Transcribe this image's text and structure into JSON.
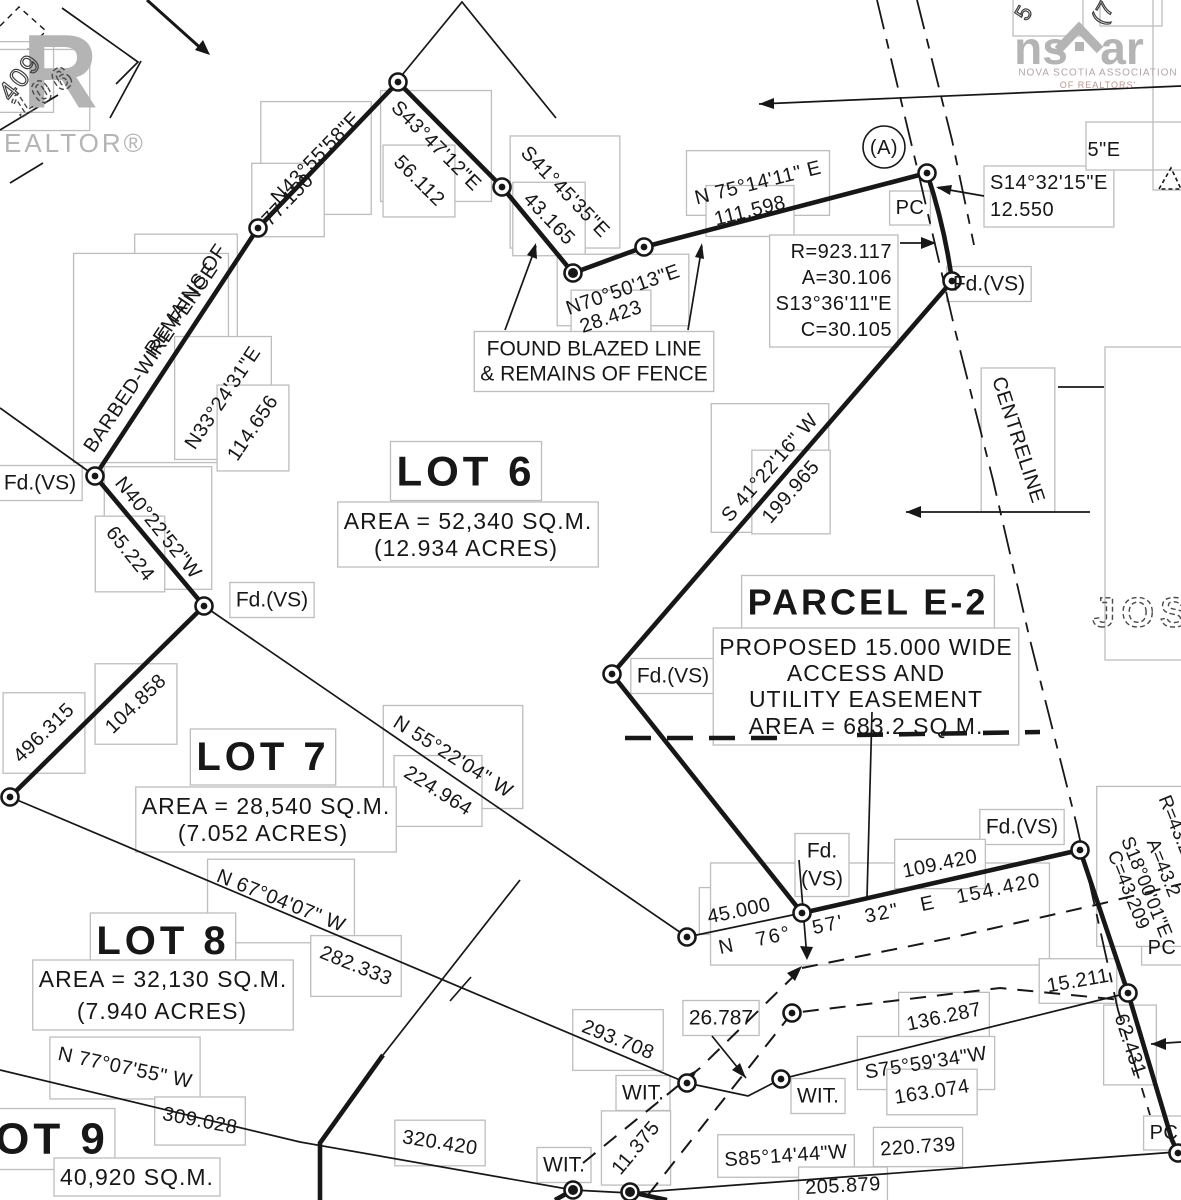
{
  "colors": {
    "ink": "#171717",
    "label_box_border": "#bdbdbd",
    "logo_gray": "#b4b4b4",
    "nsar_red_gray": "#bf9494"
  },
  "logos": {
    "realtor_r": "R",
    "realtor_text": "REALTOR®",
    "nsar_ns": "ns",
    "nsar_ar": "ar",
    "nsar_line1": "NOVA SCOTIA ASSOCIATION",
    "nsar_line2": "OF REALTORS'"
  },
  "labels": {
    "n43_bearing": "N43°55'58\"E",
    "n43_dist": "77.150",
    "s43_bearing": "S43°47'12\"E",
    "s43_dist": "56.112",
    "s41_bearing": "S41°45'35\"E",
    "s41_dist": "43.165",
    "n70_bearing": "N70°50'13\"E",
    "n70_dist": "28.423",
    "n75_bearing": "N 75°14'11\" E",
    "n75_dist": "111.598",
    "s14_bearing": "S14°32'15\"E",
    "s14_dist": "12.550",
    "pc_top": "PC",
    "point_a": "(A)",
    "curve1_r": "R=923.117",
    "curve1_a": "A=30.106",
    "curve1_bearing": "S13°36'11\"E",
    "curve1_c": "C=30.105",
    "fd_vs_1": "Fd.(VS)",
    "fd_vs_2": "Fd.(VS)",
    "fd_vs_3": "Fd.(VS)",
    "fd_vs_6": "Fd.(VS)",
    "fd_vs_5": "Fd.(VS)",
    "fd_vs_4a": "Fd.",
    "fd_vs_4b": "(VS)",
    "found_line1": "FOUND BLAZED LINE",
    "found_line2": "& REMAINS OF FENCE",
    "lot6_title": "LOT 6",
    "lot6_area": "AREA = 52,340 SQ.M.",
    "lot6_acres": "(12.934 ACRES)",
    "s4122_bearing": "S 41°22'16\" W",
    "s4122_dist": "199.965",
    "centreline": "CENTRELINE",
    "parcel_title": "PARCEL E-2",
    "parcel_l1": "PROPOSED 15.000 WIDE",
    "parcel_l2": "ACCESS AND",
    "parcel_l3": "UTILITY EASEMENT",
    "parcel_l4": "AREA = 683.2 SQ.M.",
    "remains1": "REMAINS OF",
    "remains2": "BARBED-WIRE FENCE",
    "n33_bearing": "N33°24'31\"E",
    "n33_dist": "114.656",
    "n40_bearing": "N40°22'52\"W",
    "n40_dist": "65.224",
    "d496": "496.315",
    "d104": "104.858",
    "lot7_title": "LOT 7",
    "lot7_area": "AREA = 28,540 SQ.M.",
    "lot7_acres": "(7.052 ACRES)",
    "n55_bearing": "N 55°22'04\" W",
    "n55_dist": "224.964",
    "n67_bearing": "N 67°04'07\" W",
    "n67_dist": "282.333",
    "lot8_title": "LOT 8",
    "lot8_area": "AREA = 32,130 SQ.M.",
    "lot8_acres": "(7.940 ACRES)",
    "n77_bearing": "N 77°07'55\" W",
    "n77_dist": "309.028",
    "lot9_title": "OT 9",
    "lot9_area": "40,920 SQ.M.",
    "d320": "320.420",
    "d293": "293.708",
    "wit1": "WIT.",
    "wit2": "WIT.",
    "wit3": "WIT.",
    "d11": "11.375",
    "d26": "26.787",
    "d45": "45.000",
    "n76_line": "N 76° 57' 32\" E 154.420",
    "d109": "109.420",
    "d15": "15.211",
    "d136": "136.287",
    "s75_bearing": "S75°59'34\"W",
    "s75_dist": "163.074",
    "d62": "62.431",
    "curve2_r": "R=43.2",
    "curve2_a": "A=43.2",
    "curve2_bearing": "S18°00'01\"E",
    "curve2_c": "C=43.209",
    "pc_mid": "PC",
    "pc_bottom": "PC",
    "s85_bearing": "S85°14'44\"W",
    "s85_dist": "220.739",
    "d205": "205.879",
    "jos": "JOS",
    "hw106": "106",
    "hw409": "409",
    "frag5": "5",
    "frag7": "(7",
    "frag5e": "5\"E"
  }
}
